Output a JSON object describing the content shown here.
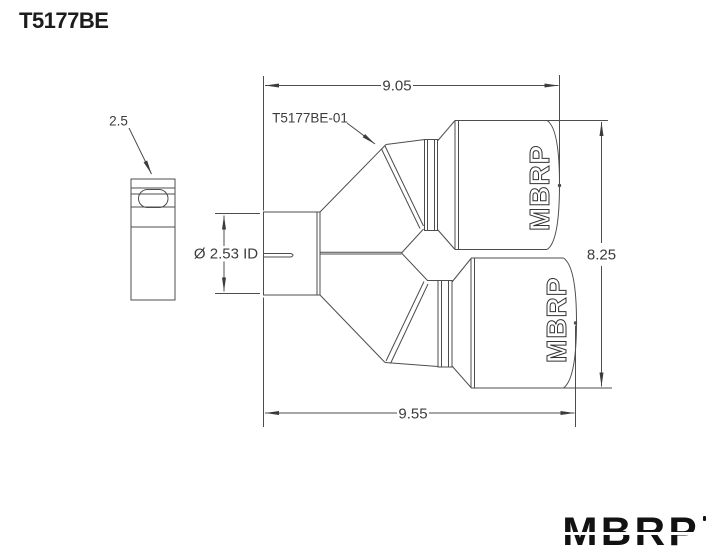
{
  "title": "T5177BE",
  "part_label": "T5177BE-01",
  "dims": {
    "top_length": "9.05",
    "bottom_length": "9.55",
    "overall_height": "8.25",
    "side_width": "2.5",
    "inlet_diameter": "Ø 2.53 ID"
  },
  "tip_text": "MBRP",
  "logo": "MBRP",
  "colors": {
    "background": "#ffffff",
    "line": "#4d4d4d",
    "text": "#3c3c3c",
    "logo": "#121212"
  }
}
